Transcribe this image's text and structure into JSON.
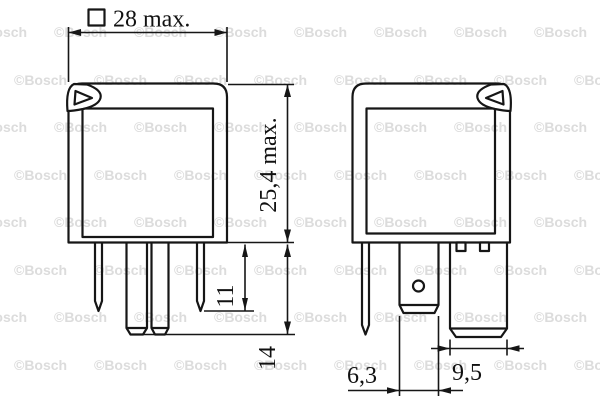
{
  "watermark": {
    "text": "©Bosch",
    "color": "#dcdcdc"
  },
  "left_view": {
    "dimensions": {
      "width": {
        "symbol": "square",
        "label": "28 max."
      },
      "height": {
        "label": "25,4 max."
      },
      "short_pin_length": {
        "label": "11"
      },
      "long_pin_length": {
        "label": "14"
      }
    }
  },
  "right_view": {
    "dimensions": {
      "center_blade_width": {
        "label": "6,3"
      },
      "wide_blade_width": {
        "label": "9,5"
      }
    }
  },
  "colors": {
    "line": "#161616",
    "background": "#ffffff"
  }
}
